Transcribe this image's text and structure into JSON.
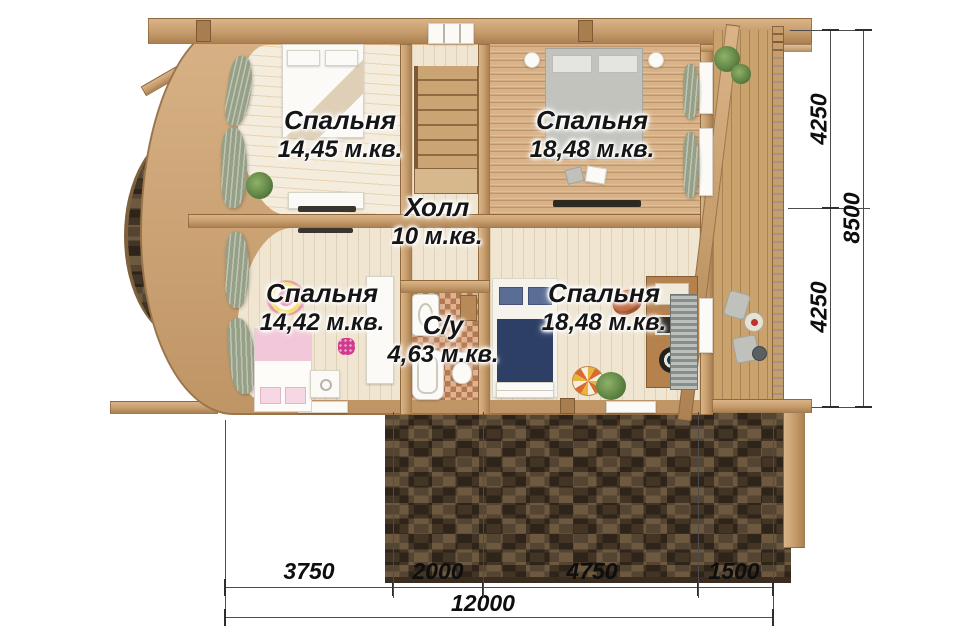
{
  "plan": {
    "rooms": {
      "bedroom_top_left": {
        "name": "Спальня",
        "area": "14,45 м.кв."
      },
      "bedroom_top_right": {
        "name": "Спальня",
        "area": "18,48 м.кв."
      },
      "hall": {
        "name": "Холл",
        "area": "10 м.кв."
      },
      "bedroom_bottom_left": {
        "name": "Спальня",
        "area": "14,42 м.кв."
      },
      "bathroom": {
        "name": "С/у",
        "area": "4,63 м.кв."
      },
      "bedroom_bottom_right": {
        "name": "Спальня",
        "area": "18,48 м.кв."
      }
    },
    "dimensions": {
      "right_top": "4250",
      "right_bottom": "4250",
      "right_total": "8500",
      "bottom_1": "3750",
      "bottom_2": "2000",
      "bottom_3": "4750",
      "bottom_4": "1500",
      "bottom_total": "12000"
    },
    "palette": {
      "timber": "#c79e6b",
      "floor_light": "#f2ead9",
      "carpet_tan": "#d9b287",
      "roof_shingle": "#4e3d2b",
      "deck": "#c9a26d",
      "bathroom_tile": "#cf8d5e",
      "bed_navy": "#2e3f66",
      "bed_pink": "#f2c7d9",
      "curtain_sage": "#96a086",
      "dimension_text": "#0e0e0e"
    }
  }
}
